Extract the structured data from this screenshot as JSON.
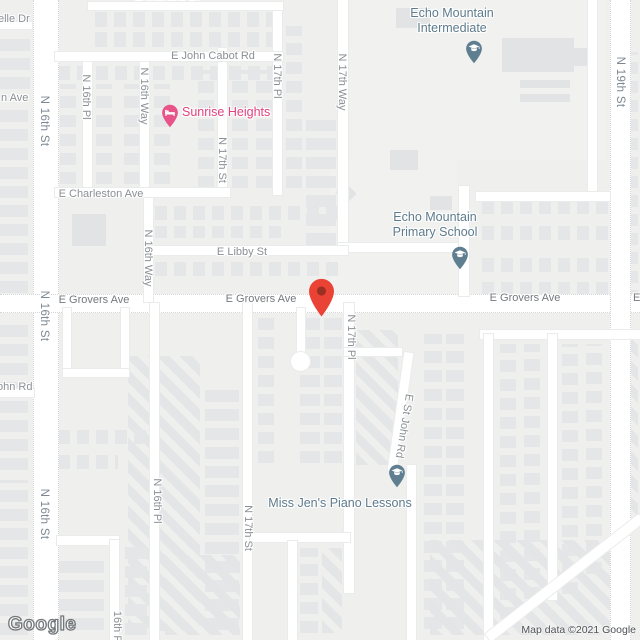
{
  "colors": {
    "background": "#efefee",
    "road": "#ffffff",
    "building": "#e5e6e7",
    "minor_road_label": "#8b9095",
    "arterial_road_label": "#7d8893",
    "school_poi": "#5d7b8c",
    "lodging_poi": "#e2417d",
    "marker_red": "#ea4335",
    "marker_dot": "#8e2c20",
    "attribution_text": "#4e5256"
  },
  "road_labels": [
    {
      "text": "E Michelle Dr"
    },
    {
      "text": "elle Dr"
    },
    {
      "text": "E John Cabot Rd"
    },
    {
      "text": "N 16th Pl"
    },
    {
      "text": "N 16th Way"
    },
    {
      "text": "N 16th St"
    },
    {
      "text": "n Ave"
    },
    {
      "text": "N 17th St"
    },
    {
      "text": "N 17th Pl"
    },
    {
      "text": "N 17th Way"
    },
    {
      "text": "N 19th St"
    },
    {
      "text": "E Charleston Ave"
    },
    {
      "text": "N 16th Way"
    },
    {
      "text": "E Libby St"
    },
    {
      "text": "E Grovers Ave"
    },
    {
      "text": "E Grovers Ave"
    },
    {
      "text": "E Grovers Ave"
    },
    {
      "text": "E"
    },
    {
      "text": "N 16th St"
    },
    {
      "text": "N 17th Pl"
    },
    {
      "text": "ohn Rd"
    },
    {
      "text": "E St John Rd"
    },
    {
      "text": "N 16th St"
    },
    {
      "text": "N 16th Pl"
    },
    {
      "text": "N 17th St"
    },
    {
      "text": "16th Pl"
    }
  ],
  "pois": [
    {
      "name": "Echo Mountain Intermediate",
      "label": "Echo Mountain\nIntermediate",
      "type": "school",
      "icon": "graduation-cap"
    },
    {
      "name": "Sunrise Heights",
      "label": "Sunrise Heights",
      "type": "lodging",
      "icon": "bed"
    },
    {
      "name": "Echo Mountain Primary School",
      "label": "Echo Mountain\nPrimary School",
      "type": "school",
      "icon": "graduation-cap"
    },
    {
      "name": "Miss Jen's Piano Lessons",
      "label": "Miss Jen's Piano Lessons",
      "type": "school",
      "icon": "graduation-cap"
    }
  ],
  "marker": {
    "description": "red place marker on E Grovers Ave",
    "color": "#ea4335"
  },
  "watermark": "Google",
  "attribution": "Map data ©2021 Google"
}
